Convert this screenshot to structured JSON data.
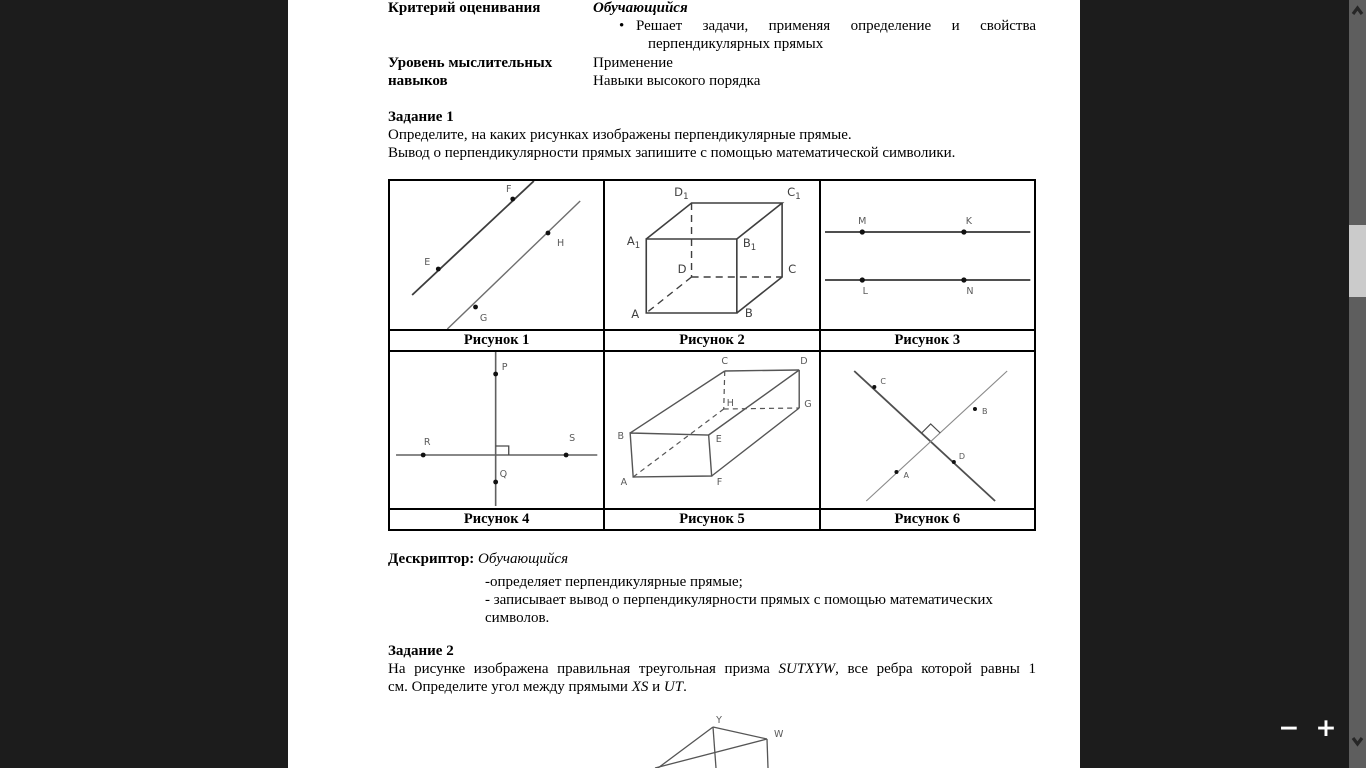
{
  "page": {
    "header": {
      "criteria_label": "Критерий оценивания",
      "criteria_value_title": "Обучающийся",
      "bullet_glyph": "•",
      "bullet_line1": "Решает задачи, применяя определение и свойства",
      "bullet_line2": "перпендикулярных прямых",
      "skills_label_line1": "Уровень мыслительных",
      "skills_label_line2": "навыков",
      "skills_value_line1": "Применение",
      "skills_value_line2": "Навыки высокого порядка"
    },
    "task1": {
      "title": "Задание 1",
      "line1": "Определите, на каких рисунках изображены перпендикулярные прямые.",
      "line2": "Вывод о перпендикулярности прямых запишите с помощью математической символики."
    },
    "figures": {
      "fig1": {
        "caption": "Рисунок 1",
        "labels": {
          "E": "E",
          "F": "F",
          "G": "G",
          "H": "H"
        }
      },
      "fig2": {
        "caption": "Рисунок 2",
        "labels": {
          "A": "A",
          "B": "B",
          "C": "C",
          "D": "D"
        },
        "sub": "1",
        "sub_base": {
          "A1": "A",
          "B1": "B",
          "C1": "C",
          "D1": "D"
        }
      },
      "fig3": {
        "caption": "Рисунок 3",
        "labels": {
          "M": "M",
          "K": "K",
          "L": "L",
          "N": "N"
        }
      },
      "fig4": {
        "caption": "Рисунок 4",
        "labels": {
          "P": "P",
          "Q": "Q",
          "R": "R",
          "S": "S"
        }
      },
      "fig5": {
        "caption": "Рисунок 5",
        "labels": {
          "A": "A",
          "B": "B",
          "C": "C",
          "D": "D",
          "E": "E",
          "F": "F",
          "G": "G",
          "H": "H"
        }
      },
      "fig6": {
        "caption": "Рисунок 6",
        "labels": {
          "A": "A",
          "B": "B",
          "C": "C",
          "D": "D"
        }
      }
    },
    "descriptor": {
      "label": "Дескриптор:",
      "subject": "Обучающийся",
      "item1": "-определяет перпендикулярные прямые;",
      "item2_line1": "- записывает вывод о перпендикулярности прямых с помощью математических",
      "item2_line2": "символов."
    },
    "task2": {
      "title": "Задание 2",
      "line1_part1": "На рисунке изображена правильная треугольная призма ",
      "line1_italic1": "SUTXYW",
      "line1_part2": ", все ребра которой  равны 1",
      "line2_part1": "см. Определите угол между прямыми ",
      "line2_italic1": "XS",
      "line2_part2": " и ",
      "line2_italic2": "UT",
      "line2_part3": ".",
      "figure_labels": {
        "Y": "Y",
        "W": "W"
      }
    }
  },
  "viewer": {
    "zoom_out": "−",
    "zoom_in": "+",
    "colors": {
      "backdrop": "#1c1c1c",
      "page": "#ffffff",
      "scrollbar_track": "#5e5e5e",
      "scrollbar_thumb": "#cbcbcb"
    }
  }
}
